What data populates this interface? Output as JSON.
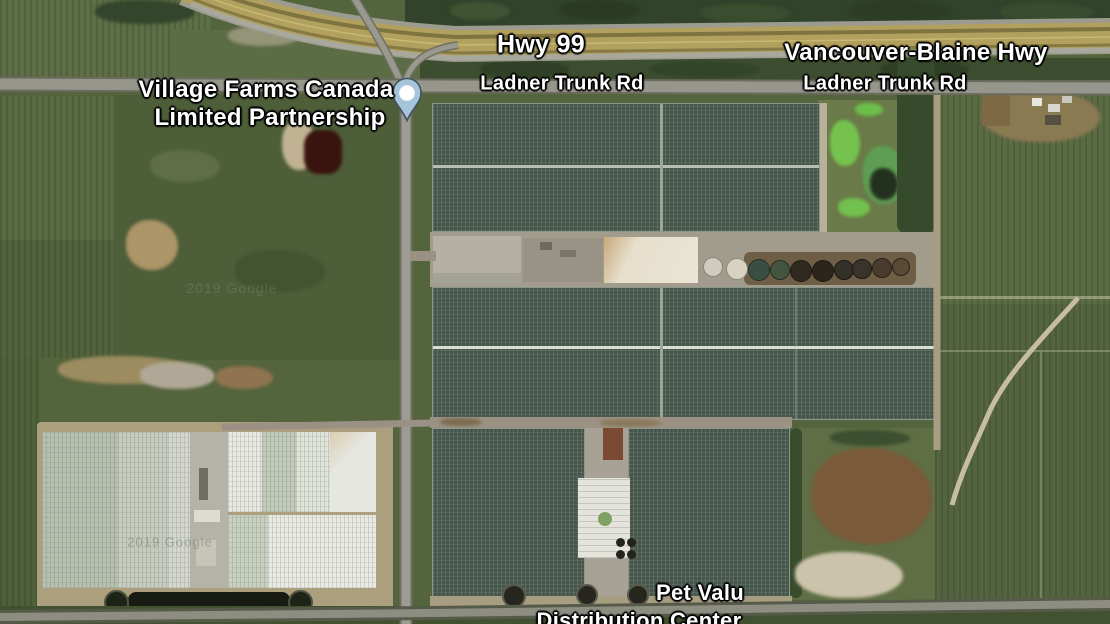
{
  "map": {
    "view": "satellite",
    "labels": {
      "hwy_99": "Hwy 99",
      "vancouver_blaine_hwy": "Vancouver-Blaine Hwy",
      "ladner_trunk_rd_west": "Ladner Trunk Rd",
      "ladner_trunk_rd_east": "Ladner Trunk Rd",
      "village_farms_line1": "Village Farms Canada",
      "village_farms_line2": "Limited Partnership",
      "pet_valu_line1": "Pet Valu",
      "pet_valu_line2": "Distribution Center",
      "watermark": "2019 Google"
    },
    "marker": {
      "place": "Village Farms Canada Limited Partnership",
      "pin_color": "#a6c5da"
    },
    "colors": {
      "field_green": "#54643d",
      "pasture_green": "#4d5e39",
      "tree_green": "#31432a",
      "greenhouse_dark": "#47564c",
      "greenhouse_light": "#dfe1da",
      "highway_tan": "#b2a05e",
      "road_gray": "#97968c",
      "dirt_tan": "#a89a78",
      "pond_dark": "#171b11",
      "label_text": "#ffffff"
    }
  }
}
